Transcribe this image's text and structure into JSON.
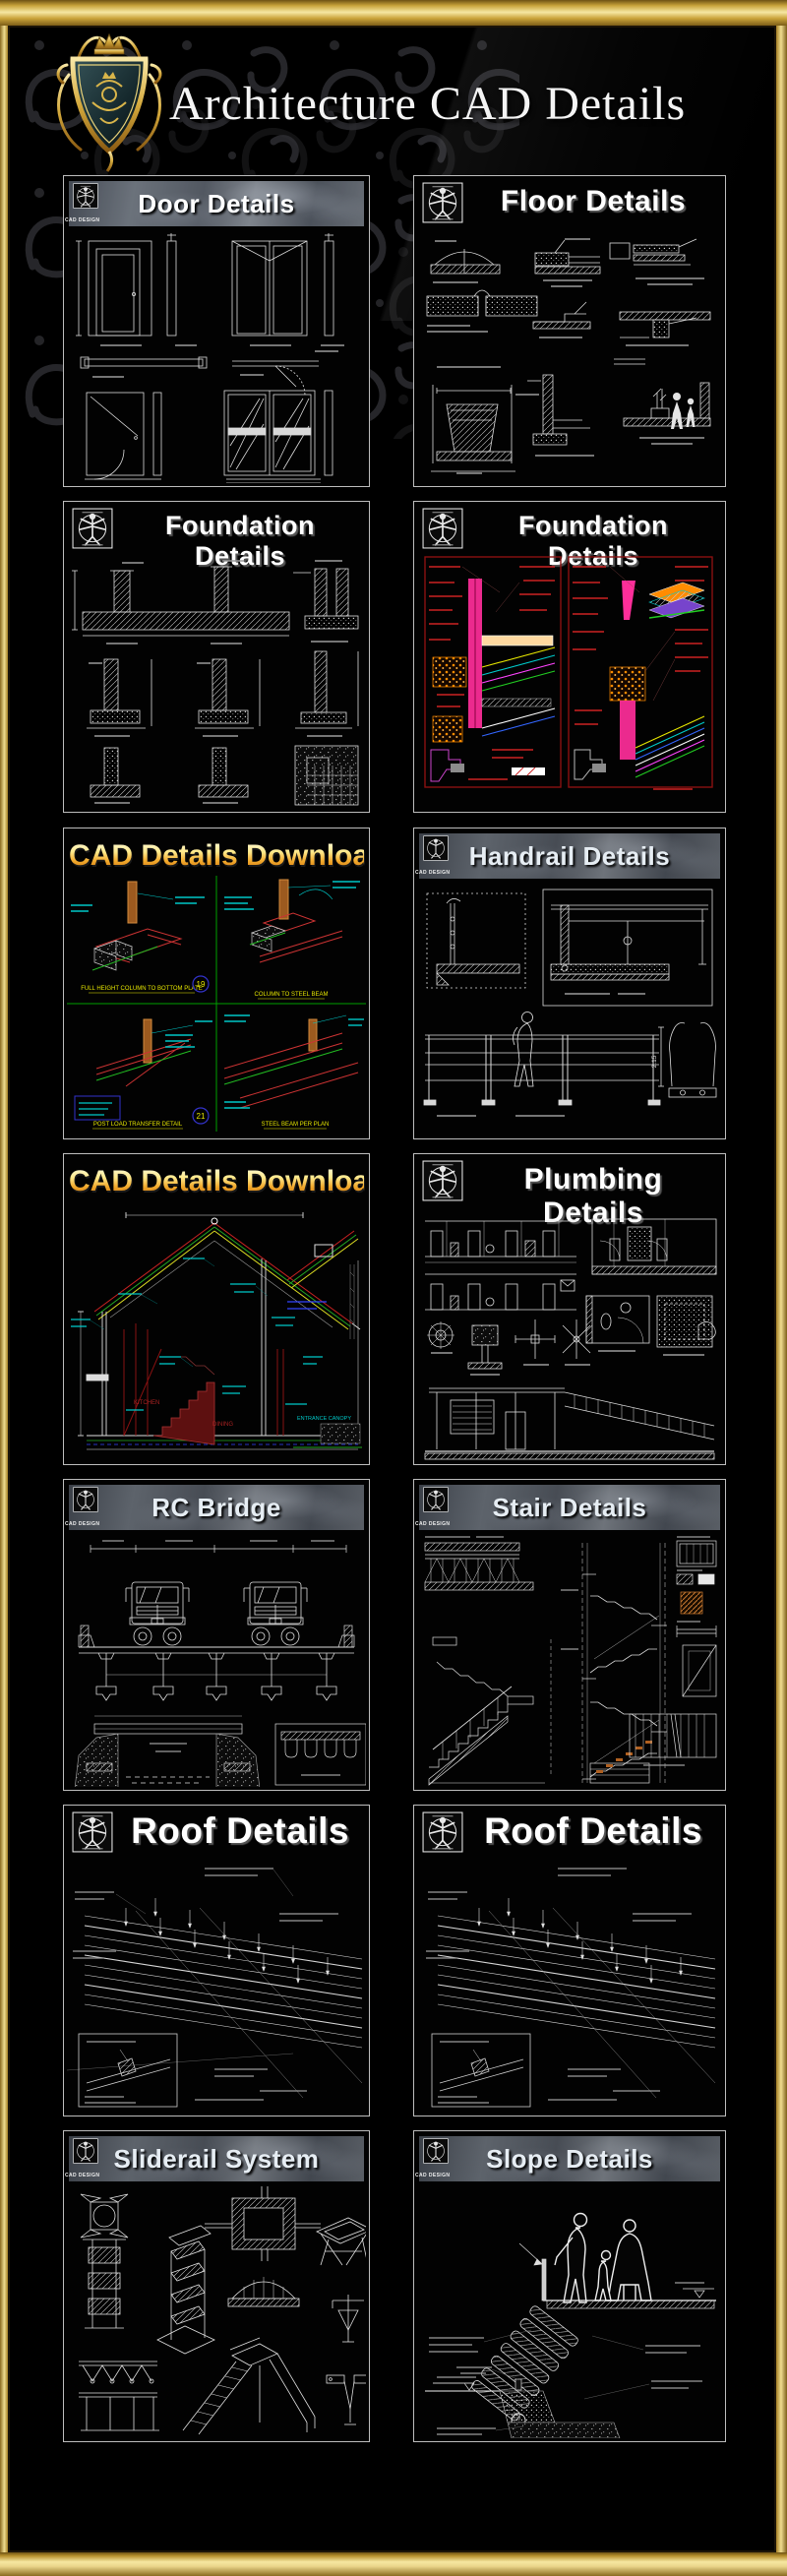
{
  "header": {
    "title": "Architecture CAD Details"
  },
  "branding": {
    "logo_caption": "CAD DESIGN"
  },
  "panels": [
    {
      "id": "door-details",
      "title": "Door Details",
      "header_style": "bar"
    },
    {
      "id": "floor-details",
      "title": "Floor Details",
      "header_style": "plain"
    },
    {
      "id": "foundation-details-left",
      "title": "Foundation Details",
      "header_style": "plain"
    },
    {
      "id": "foundation-details-right",
      "title": "Foundation Details",
      "header_style": "plain"
    },
    {
      "id": "cad-details-download-framing",
      "title": "CAD Details Download",
      "header_style": "gradient",
      "labels": {
        "detail_19": "19",
        "detail_21": "21",
        "caption_q1": "FULL HEIGHT COLUMN TO BOTTOM PLATE",
        "caption_q2": "COLUMN TO STEEL BEAM",
        "caption_q3": "POST LOAD TRANSFER DETAIL",
        "caption_q4": "STEEL BEAM PER PLAN"
      }
    },
    {
      "id": "handrail-details",
      "title": "Handrail Details",
      "header_style": "bar",
      "labels": {
        "dim": "2.15"
      }
    },
    {
      "id": "cad-details-download-house",
      "title": "CAD Details Download",
      "header_style": "gradient",
      "labels": {
        "room_left": "KITCHEN",
        "room_right": "DINING",
        "canopy": "ENTRANCE CANOPY"
      }
    },
    {
      "id": "plumbing-details",
      "title": "Plumbing Details",
      "header_style": "plain"
    },
    {
      "id": "rc-bridge",
      "title": "RC Bridge",
      "header_style": "bar"
    },
    {
      "id": "stair-details",
      "title": "Stair Details",
      "header_style": "bar"
    },
    {
      "id": "roof-details-left",
      "title": "Roof Details",
      "header_style": "plain"
    },
    {
      "id": "roof-details-right",
      "title": "Roof Details",
      "header_style": "plain"
    },
    {
      "id": "sliderail-system",
      "title": "Sliderail System",
      "header_style": "bar"
    },
    {
      "id": "slope-details",
      "title": "Slope Details",
      "header_style": "bar"
    }
  ],
  "colors": {
    "frame_gold": "#caa43c",
    "panel_border": "#bdbdbd",
    "bar_text": "#e6edf3",
    "download_gradient_top": "#fffbdc",
    "download_gradient_bottom": "#c96f10",
    "cad_green": "#00a000",
    "cad_cyan": "#00c6c6",
    "cad_red": "#c32222",
    "cad_magenta": "#ff2e9a",
    "cad_orange": "#ff8c00",
    "cad_yellow": "#e8e800"
  }
}
